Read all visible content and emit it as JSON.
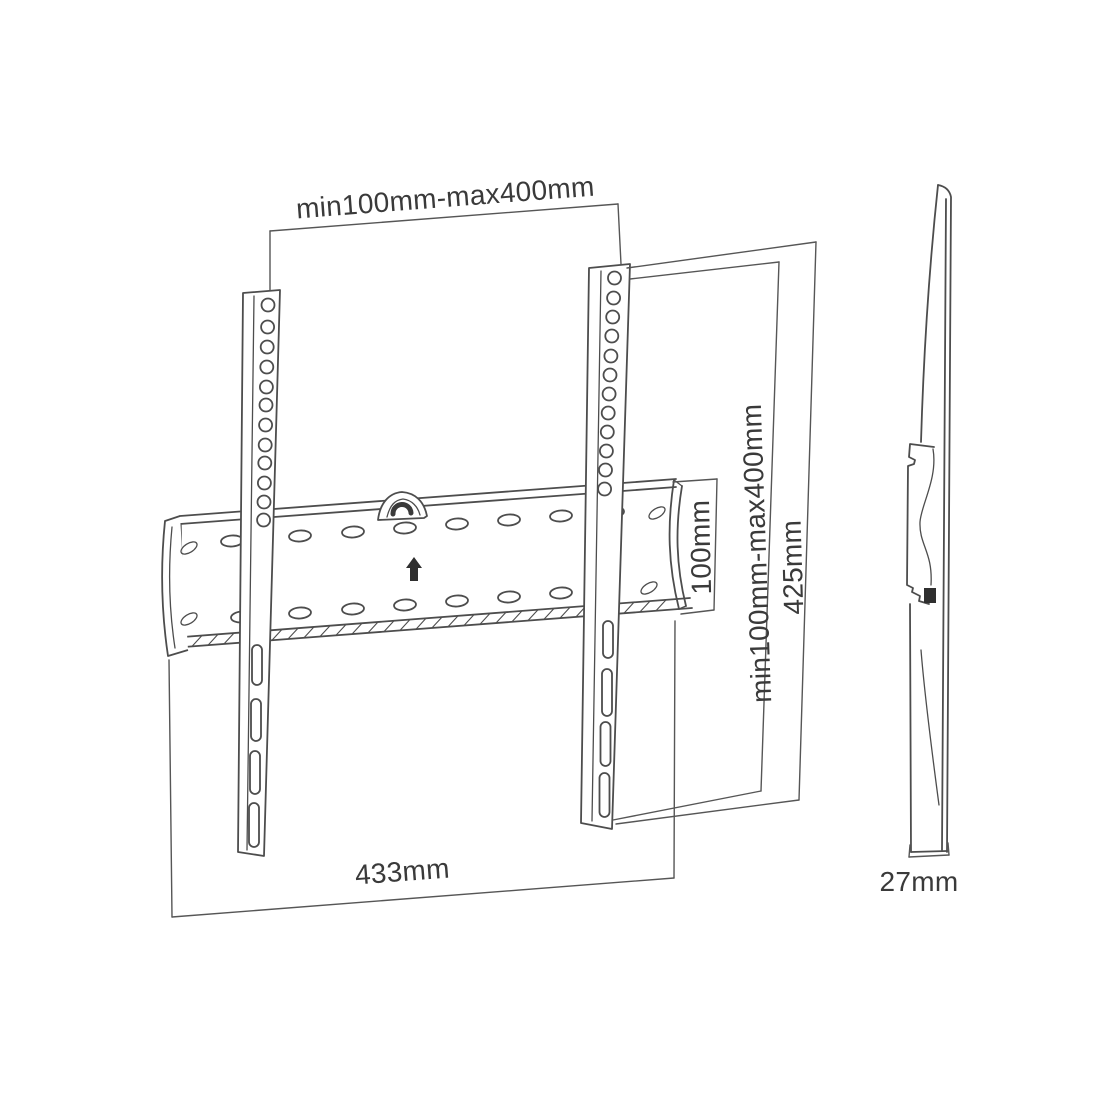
{
  "front_view": {
    "top_dimension_label": "min100mm-max400mm",
    "vesa_height_label": "min100mm-max400mm",
    "bracket_height_label": "425mm",
    "plate_height_label": "100mm",
    "plate_width_label": "433mm"
  },
  "side_view": {
    "depth_label": "27mm"
  },
  "colors": {
    "line": "#4d4d4d",
    "text": "#3a3a3a",
    "background": "#ffffff"
  }
}
